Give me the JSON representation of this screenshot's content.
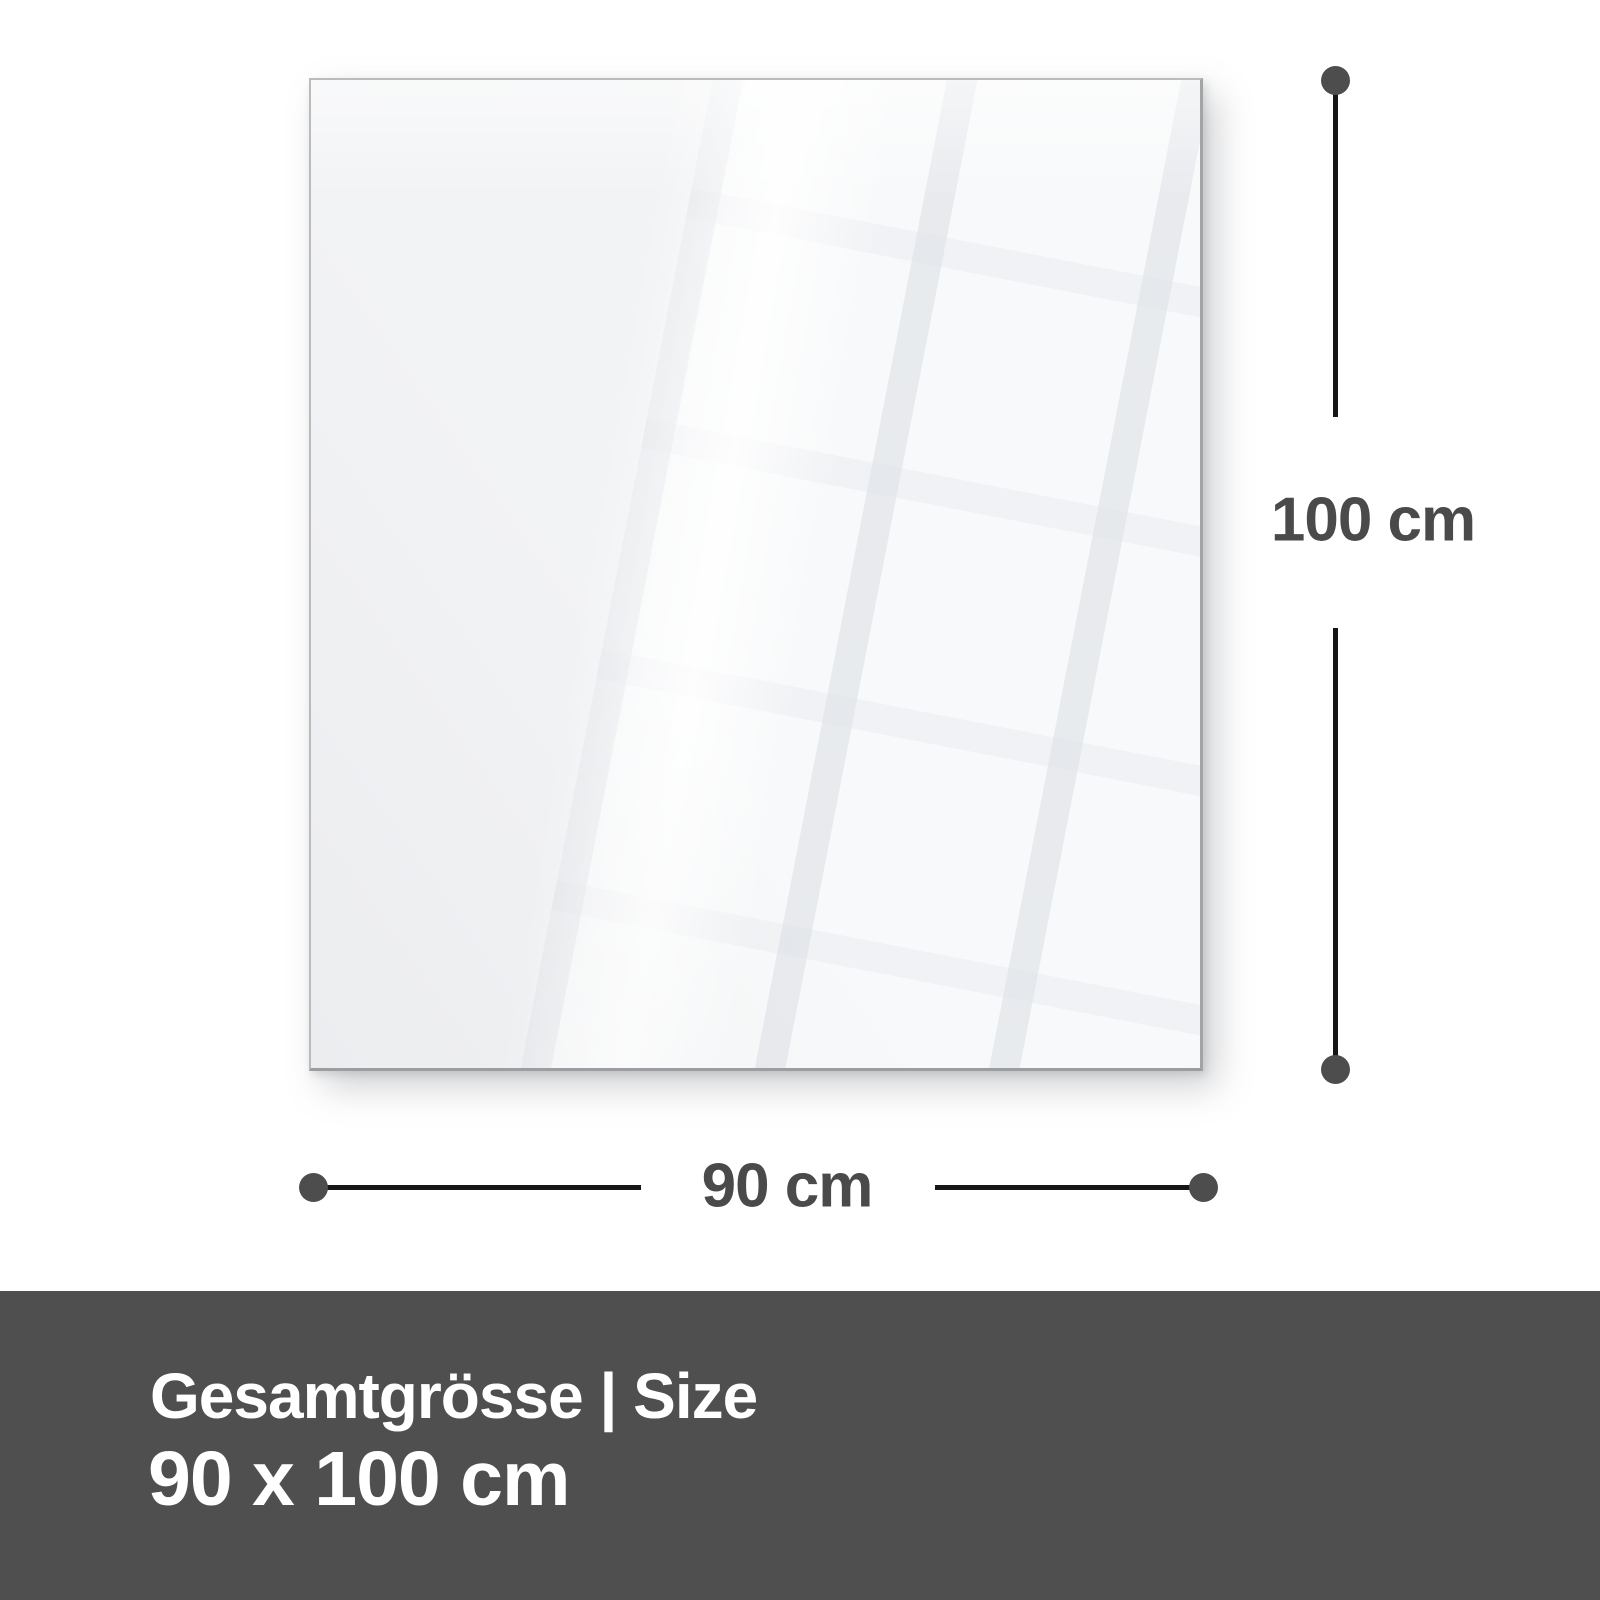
{
  "diagram": {
    "height_dimension": {
      "label": "100 cm"
    },
    "width_dimension": {
      "label": "90 cm"
    }
  },
  "footer": {
    "title": "Gesamtgrösse | Size",
    "size": "90 x 100 cm"
  },
  "colors": {
    "background": "#ffffff",
    "panel_fill": "#f2f3f5",
    "dimension_line": "#161616",
    "endpoint_dot": "#4d4d4d",
    "label_text": "#4a4a4a",
    "footer_bg": "#4f4f4f",
    "footer_text": "#ffffff"
  }
}
